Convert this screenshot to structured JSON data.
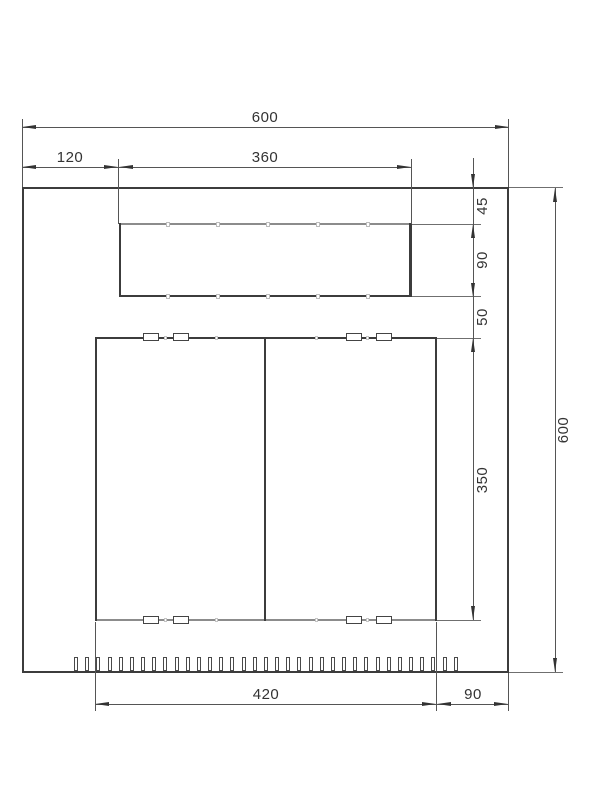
{
  "drawing": {
    "type": "technical-dimension-drawing",
    "dims": {
      "overall_width": "600",
      "overall_height": "600",
      "cutout_left_offset": "120",
      "cutout_width": "360",
      "cutout_top_offset": "45",
      "cutout_height": "90",
      "cutout_to_doors_gap": "50",
      "doors_height": "350",
      "doors_width": "420",
      "doors_right_margin": "90"
    },
    "perforation": {
      "count": 35
    }
  }
}
